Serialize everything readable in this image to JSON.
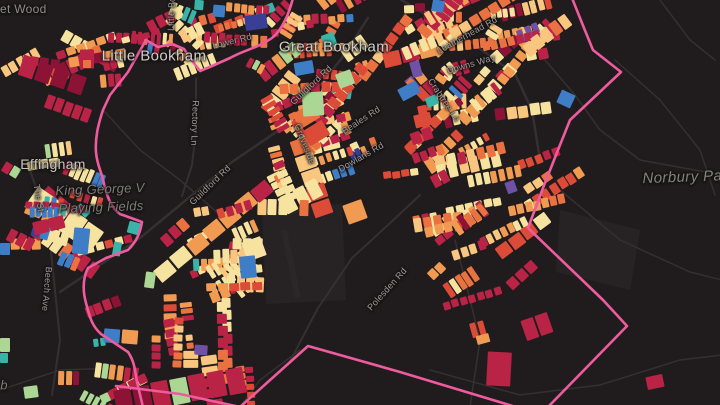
{
  "map": {
    "title": "Dark parcel map of Little Bookham / Great Bookham / Effingham area",
    "background": "#201c1d",
    "boundary_color": "#ee5b9e",
    "road_color": "#343030",
    "field_color": "#272223",
    "seed": 1337,
    "colors": {
      "cream": "#f7e3a0",
      "lightOrange": "#f8c67e",
      "orange": "#f19a52",
      "deepOrange": "#e97240",
      "red": "#dc4a38",
      "crimson": "#b92345",
      "darkRed": "#8c1336",
      "blue": "#3f7ec6",
      "teal": "#3ab3a8",
      "green": "#abd693",
      "purple": "#6f51a5",
      "navy": "#3a3f96"
    },
    "palettes": {
      "main": {
        "cream": 24,
        "lightOrange": 15,
        "orange": 16,
        "deepOrange": 8,
        "red": 10,
        "crimson": 13,
        "darkRed": 3,
        "blue": 3,
        "teal": 2.5,
        "green": 2,
        "purple": 1.5,
        "navy": 0.8
      },
      "warm": {
        "cream": 28,
        "lightOrange": 18,
        "orange": 18,
        "deepOrange": 10,
        "red": 10,
        "crimson": 13,
        "darkRed": 2,
        "teal": 1
      },
      "redHeavy": {
        "crimson": 28,
        "red": 16,
        "orange": 16,
        "cream": 14,
        "lightOrange": 8,
        "deepOrange": 10,
        "darkRed": 7,
        "purple": 1
      },
      "mixedCool": {
        "crimson": 24,
        "green": 14,
        "teal": 12,
        "cream": 14,
        "orange": 12,
        "blue": 8,
        "red": 10,
        "darkRed": 6
      }
    },
    "clusters": [
      {
        "x": 252,
        "y": 0,
        "w": 205,
        "h": 112,
        "n": 44,
        "a": -25,
        "aj": 70,
        "pal": "main",
        "s": 1
      },
      {
        "x": 432,
        "y": 8,
        "w": 105,
        "h": 115,
        "n": 24,
        "a": -32,
        "aj": 55,
        "pal": "main",
        "s": 1
      },
      {
        "x": 300,
        "y": 112,
        "w": 158,
        "h": 80,
        "n": 26,
        "a": -30,
        "aj": 55,
        "pal": "main",
        "s": 1
      },
      {
        "x": 258,
        "y": 95,
        "w": 55,
        "h": 92,
        "n": 11,
        "a": 62,
        "aj": 28,
        "pal": "warm",
        "s": 1
      },
      {
        "x": 408,
        "y": 148,
        "w": 125,
        "h": 88,
        "n": 15,
        "a": -22,
        "aj": 30,
        "pal": "warm",
        "s": 1.05
      },
      {
        "x": 428,
        "y": 218,
        "w": 115,
        "h": 112,
        "n": 13,
        "a": -25,
        "aj": 40,
        "pal": "redHeavy",
        "s": 1.05
      },
      {
        "x": 150,
        "y": 0,
        "w": 105,
        "h": 92,
        "n": 15,
        "a": 5,
        "aj": 80,
        "pal": "main",
        "s": 1
      },
      {
        "x": 0,
        "y": 0,
        "w": 80,
        "h": 125,
        "n": 9,
        "a": 0,
        "aj": 70,
        "pal": "redHeavy",
        "s": 1.05
      },
      {
        "x": 0,
        "y": 148,
        "w": 100,
        "h": 112,
        "n": 15,
        "a": 12,
        "aj": 70,
        "pal": "main",
        "s": 1
      },
      {
        "x": 158,
        "y": 203,
        "w": 118,
        "h": 100,
        "n": 26,
        "a": -15,
        "aj": 55,
        "pal": "warm",
        "s": 1
      },
      {
        "x": 152,
        "y": 296,
        "w": 108,
        "h": 106,
        "n": 13,
        "a": 85,
        "aj": 18,
        "pal": "redHeavy",
        "s": 1.05
      },
      {
        "x": 0,
        "y": 300,
        "w": 135,
        "h": 102,
        "n": 9,
        "a": 0,
        "aj": 60,
        "pal": "mixedCool",
        "s": 1
      },
      {
        "x": 0,
        "y": 195,
        "w": 48,
        "h": 62,
        "n": 5,
        "a": 0,
        "aj": 60,
        "pal": "mixedCool",
        "s": 0.9
      },
      {
        "x": 100,
        "y": 28,
        "w": 48,
        "h": 70,
        "n": 5,
        "a": 10,
        "aj": 60,
        "pal": "redHeavy",
        "s": 0.9
      }
    ],
    "holes": [
      [
        348,
        86,
        66,
        56
      ],
      [
        262,
        208,
        80,
        96
      ]
    ],
    "landmarks": [
      {
        "x": 558,
        "y": 92,
        "w": 15,
        "h": 14,
        "c": "blue",
        "r": 25
      },
      {
        "x": 476,
        "y": 334,
        "w": 13,
        "h": 9,
        "c": "orange",
        "r": -15
      },
      {
        "x": 487,
        "y": 352,
        "w": 24,
        "h": 34,
        "c": "crimson",
        "r": 3
      },
      {
        "x": 646,
        "y": 375,
        "w": 17,
        "h": 13,
        "c": "crimson",
        "r": -12
      },
      {
        "x": 194,
        "y": 345,
        "w": 13,
        "h": 10,
        "c": "purple",
        "r": 4
      },
      {
        "x": 80,
        "y": 49,
        "w": 14,
        "h": 19,
        "c": "crimson",
        "r": 0
      },
      {
        "x": 83,
        "y": 60,
        "w": 8,
        "h": 8,
        "c": "deepOrange",
        "r": 0
      },
      {
        "x": 245,
        "y": 14,
        "w": 22,
        "h": 15,
        "c": "navy",
        "r": -8
      },
      {
        "x": 294,
        "y": 61,
        "w": 19,
        "h": 13,
        "c": "blue",
        "r": -10
      },
      {
        "x": 399,
        "y": 84,
        "w": 20,
        "h": 13,
        "c": "blue",
        "r": -28
      },
      {
        "x": 302,
        "y": 92,
        "w": 21,
        "h": 24,
        "c": "green",
        "r": -4
      },
      {
        "x": 337,
        "y": 71,
        "w": 16,
        "h": 15,
        "c": "green",
        "r": -20
      },
      {
        "x": 411,
        "y": 61,
        "w": 10,
        "h": 16,
        "c": "purple",
        "r": -15
      },
      {
        "x": 322,
        "y": 33,
        "w": 13,
        "h": 13,
        "c": "teal",
        "r": -20
      },
      {
        "x": 426,
        "y": 96,
        "w": 12,
        "h": 10,
        "c": "teal",
        "r": -25
      },
      {
        "x": 506,
        "y": 181,
        "w": 10,
        "h": 12,
        "c": "purple",
        "r": -20
      },
      {
        "x": 113,
        "y": 242,
        "w": 8,
        "h": 14,
        "c": "teal",
        "r": 10
      },
      {
        "x": 145,
        "y": 272,
        "w": 10,
        "h": 16,
        "c": "green",
        "r": 8
      },
      {
        "x": 73,
        "y": 228,
        "w": 16,
        "h": 26,
        "c": "blue",
        "r": 6
      },
      {
        "x": 240,
        "y": 256,
        "w": 16,
        "h": 22,
        "c": "blue",
        "r": -6
      },
      {
        "x": 128,
        "y": 222,
        "w": 12,
        "h": 12,
        "c": "teal",
        "r": 15
      },
      {
        "x": 0,
        "y": 338,
        "w": 10,
        "h": 14,
        "c": "green",
        "r": 0
      },
      {
        "x": 0,
        "y": 353,
        "w": 8,
        "h": 10,
        "c": "teal",
        "r": 0
      },
      {
        "x": 24,
        "y": 386,
        "w": 14,
        "h": 12,
        "c": "green",
        "r": -8
      },
      {
        "x": 0,
        "y": 243,
        "w": 10,
        "h": 12,
        "c": "blue",
        "r": 0
      },
      {
        "x": 432,
        "y": 0,
        "w": 12,
        "h": 12,
        "c": "blue",
        "r": 10
      },
      {
        "x": 194,
        "y": 0,
        "w": 9,
        "h": 10,
        "c": "teal",
        "r": 5
      },
      {
        "x": 213,
        "y": 5,
        "w": 12,
        "h": 12,
        "c": "blue",
        "r": 5
      }
    ],
    "fields": [
      {
        "d": "M262,208 L342,204 L346,300 L266,304 Z"
      },
      {
        "d": "M560,210 L640,230 L630,290 L556,272 Z"
      }
    ],
    "runway": {
      "d": "M284,230 L298,298",
      "w": 6,
      "color": "#2b2627"
    },
    "roads": [
      {
        "d": "M60,292 L140,238 L232,162 L288,124 L342,58 L368,18",
        "w": 2.5
      },
      {
        "d": "M395,-4 L468,40 L515,74 L532,110 L540,160",
        "w": 2.5
      },
      {
        "d": "M196,78 L196,130 L192,165 L182,196",
        "w": 2
      },
      {
        "d": "M288,365 L318,308 L352,258 L388,225 L420,195",
        "w": 2
      },
      {
        "d": "M50,242 L56,300 L60,340 L52,395",
        "w": 2
      },
      {
        "d": "M30,170 L42,205 L48,232",
        "w": 2
      },
      {
        "d": "M615,60 L660,100 L700,150 L715,195",
        "w": 1.5
      },
      {
        "d": "M560,190 L620,240 L690,272 L722,280",
        "w": 1.5
      },
      {
        "d": "M430,370 L520,395 L600,385 L680,360 L722,355",
        "w": 1.5
      },
      {
        "d": "M660,0 L690,40 L715,60",
        "w": 1.5
      },
      {
        "d": "M0,390 L60,370 L120,368",
        "w": 1.5
      },
      {
        "d": "M240,407 L260,380 L300,350",
        "w": 1.5
      },
      {
        "d": "M455,240 L470,300 L480,340 L470,407",
        "w": 1.5
      },
      {
        "d": "M545,60 L575,95 L600,130 L640,160 L722,175",
        "w": 1.5
      },
      {
        "d": "M103,110 L140,150 L180,180 L220,215 L262,248",
        "w": 1.5
      }
    ],
    "boundary": [
      "M293,-2 C289,14 282,30 272,38 C258,48 244,50 230,58 L212,66 L200,71 L190,58 L184,49 L172,44 L158,47 L146,40 L128,72 L110,95 L103,110 C98,125 95,138 96,152 C97,166 102,172 104,184 C108,200 112,208 120,214 L142,222 C140,234 136,242 128,250 L106,258 L88,268 C82,280 83,292 86,303 C90,318 92,326 101,334 L128,352 C135,362 135,372 137,382 L143,407",
      "M572,-2 L584,28 L593,50 L621,72 L570,120 L558,150 L543,188 L528,228 L603,300 L627,326 L548,407",
      "M116,386 L180,394 L240,407 L308,346 L400,372 L516,407"
    ],
    "labels": [
      {
        "text": "Barnet Wood",
        "x": 10,
        "y": 9,
        "rot": 0,
        "cls": "district"
      },
      {
        "text": "Little Bookham",
        "x": 154,
        "y": 56,
        "rot": 0,
        "cls": "town"
      },
      {
        "text": "Great Bookham",
        "x": 334,
        "y": 47,
        "rot": 0,
        "cls": "town"
      },
      {
        "text": "Effingham",
        "x": 53,
        "y": 164,
        "rot": 0,
        "cls": "town-sm"
      },
      {
        "text": "Norbury Park",
        "x": 689,
        "y": 177,
        "rot": -2,
        "cls": "park-lg"
      },
      {
        "text": "King George V",
        "x": 100,
        "y": 189,
        "rot": -2,
        "cls": "park"
      },
      {
        "text": "Playing Fields",
        "x": 101,
        "y": 207,
        "rot": -2,
        "cls": "park"
      },
      {
        "text": "Lower Rd",
        "x": 232,
        "y": 41,
        "rot": -14,
        "cls": "road"
      },
      {
        "text": "Little Bookham St",
        "x": 172,
        "y": -6,
        "rot": -88,
        "cls": "road"
      },
      {
        "text": "Rectory Ln",
        "x": 195,
        "y": 123,
        "rot": 92,
        "cls": "road"
      },
      {
        "text": "Guildford Rd",
        "x": 311,
        "y": 85,
        "rot": -43,
        "cls": "road"
      },
      {
        "text": "Guildford Rd",
        "x": 210,
        "y": 185,
        "rot": -44,
        "cls": "road"
      },
      {
        "text": "Leatherhead Rd",
        "x": 467,
        "y": 35,
        "rot": -29,
        "cls": "road"
      },
      {
        "text": "Downs Way",
        "x": 471,
        "y": 64,
        "rot": -16,
        "cls": "road"
      },
      {
        "text": "Crabtree Ln",
        "x": 444,
        "y": 100,
        "rot": 56,
        "cls": "road"
      },
      {
        "text": "Groveside",
        "x": 305,
        "y": 144,
        "rot": 68,
        "cls": "road"
      },
      {
        "text": "Beales Rd",
        "x": 361,
        "y": 120,
        "rot": -33,
        "cls": "road"
      },
      {
        "text": "Dowlans Rd",
        "x": 361,
        "y": 157,
        "rot": -30,
        "cls": "road"
      },
      {
        "text": "Polesden Rd",
        "x": 387,
        "y": 289,
        "rot": -48,
        "cls": "road"
      },
      {
        "text": "Beech Ave",
        "x": 47,
        "y": 289,
        "rot": 95,
        "cls": "road"
      },
      {
        "text": "The St",
        "x": 39,
        "y": 198,
        "rot": 80,
        "cls": "road"
      },
      {
        "text": "b",
        "x": 4,
        "y": 385,
        "rot": 0,
        "cls": "park"
      }
    ]
  }
}
